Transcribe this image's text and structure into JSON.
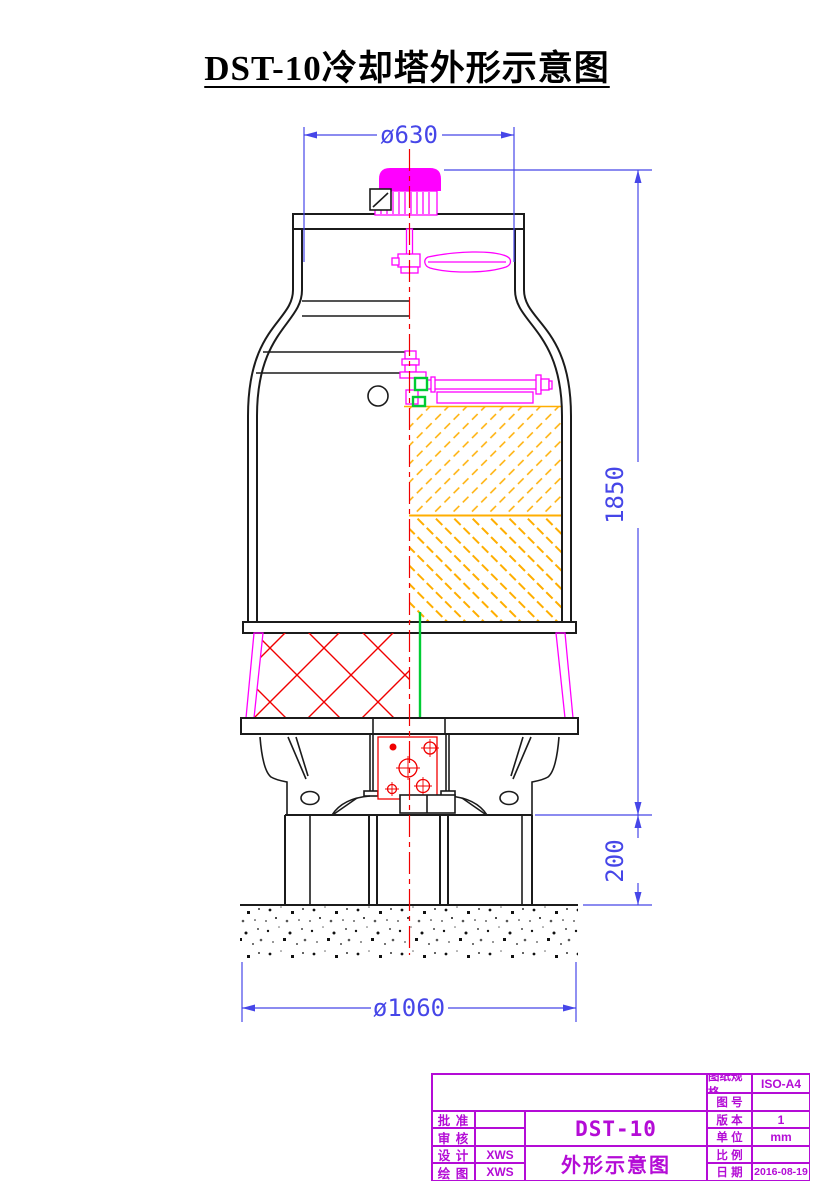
{
  "page": {
    "title": "DST-10冷却塔外形示意图"
  },
  "dimensions": {
    "top_diameter": "ø630",
    "total_height": "1850",
    "base_height": "200",
    "bottom_diameter": "ø1060"
  },
  "title_block": {
    "left_rows": [
      {
        "label": "批 准",
        "value": ""
      },
      {
        "label": "审 核",
        "value": ""
      },
      {
        "label": "设 计",
        "value": "XWS"
      },
      {
        "label": "绘 图",
        "value": "XWS"
      }
    ],
    "model": "DST-10",
    "drawing_name": "外形示意图",
    "right_rows": [
      {
        "label": "图纸规格",
        "value": "ISO-A4"
      },
      {
        "label": "图 号",
        "value": ""
      },
      {
        "label": "版 本",
        "value": "1"
      },
      {
        "label": "单 位",
        "value": "mm"
      },
      {
        "label": "比 例",
        "value": ""
      },
      {
        "label": "日 期",
        "value": "2016-08-19"
      }
    ]
  },
  "colors": {
    "outline": "#1b1b1b",
    "magenta_parts": "#ff00ff",
    "red_centerline_hatch": "#f00000",
    "green_pipe_line": "#00cc33",
    "orange_fill_hatch": "#ffae00",
    "blue_dimensions": "#4646e8",
    "title_block_magenta": "#b40cd6"
  }
}
